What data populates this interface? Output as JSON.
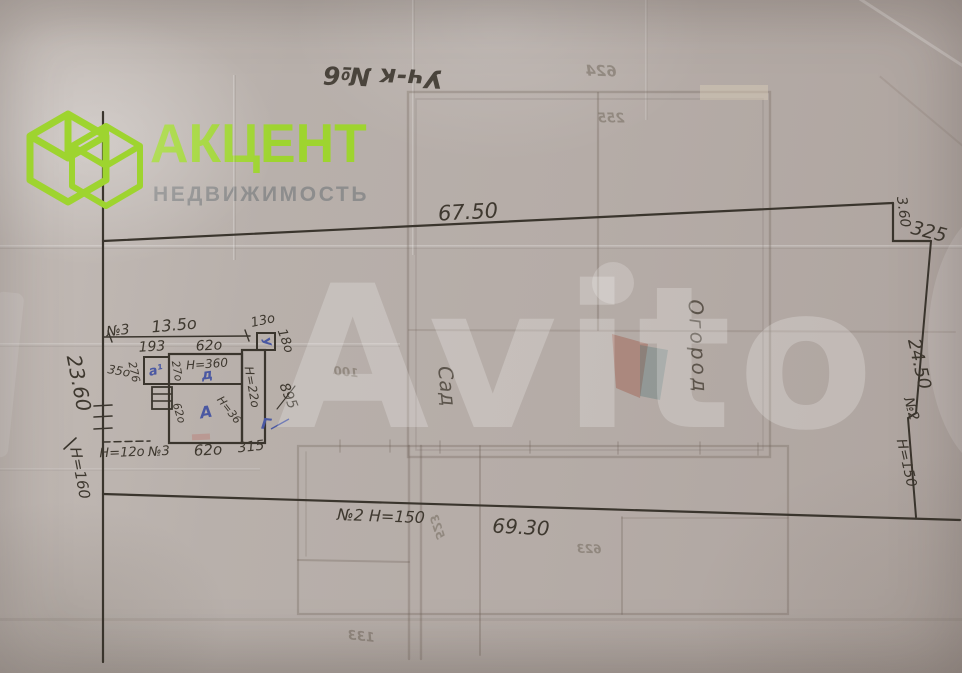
{
  "branding": {
    "title": "АКЦЕНТ",
    "subtitle": "НЕДВИЖИМОСТЬ"
  },
  "watermark": {
    "text": "Avito"
  },
  "plot": {
    "title": "Уч-к №6",
    "dims": {
      "top_length": "67.50",
      "bottom_length": "69.30",
      "left_length": "23.60",
      "right_length": "24.50",
      "step_width": "325",
      "step_height": "3.60",
      "left_note": "Н=160",
      "right_note_no": "№2",
      "right_note_h": "Н=150",
      "bottom_note": "№2  Н=150"
    },
    "areas": {
      "garden": "Сад",
      "kitchen_garden": "Огород"
    },
    "house": {
      "setback_no": "№3",
      "setback": "13.5о",
      "d193": "193",
      "d620_top": "62о",
      "d130": "13о",
      "d180": "18о",
      "d350": "35о",
      "d276": "276",
      "d270": "27о",
      "h360": "Н=360",
      "h220": "Н=22о",
      "h36": "Н=36",
      "d620_left": "62о",
      "d895": "895",
      "h120": "Н=12о",
      "no3": "№3",
      "d620_bottom": "62о",
      "d315": "315",
      "lit_a1": "а¹",
      "lit_u": "У",
      "lit_d": "д",
      "lit_main": "А",
      "lit_g": "Г"
    },
    "bleed": {
      "n1": "624",
      "n2": "255",
      "n3": "100",
      "n4": "523",
      "n5": "623",
      "n6": "133"
    }
  }
}
